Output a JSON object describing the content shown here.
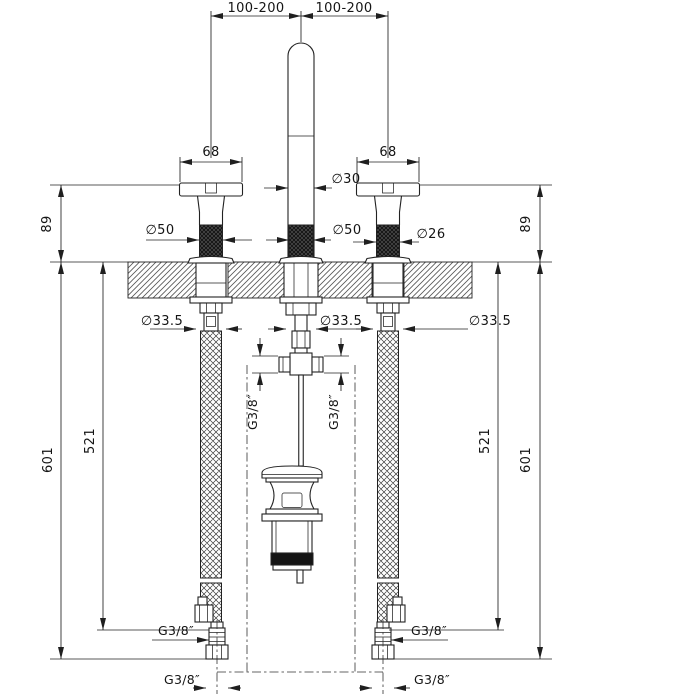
{
  "page": {
    "background": "#ffffff",
    "line_color": "#222222",
    "knurl_color": "#181818",
    "thread_band_color": "#151515"
  },
  "drawing": {
    "type": "technical-installation-drawing",
    "subject": "3-hole basin mixer with cross handles, high spout, pop-up waste and flexible supply hoses",
    "dimensions": {
      "top_span_left": "100-200",
      "top_span_right": "100-200",
      "handle_width_left": "68",
      "handle_width_right": "68",
      "spout_diameter": "∅30",
      "left_handle_diameter": "∅50",
      "spout_base_diameter": "∅50",
      "cartridge_diameter": "∅26",
      "deck_height_left": "89",
      "deck_height_right": "89",
      "shank_diameter_left": "∅33.5",
      "shank_diameter_center": "∅33.5",
      "shank_diameter_right": "∅33.5",
      "hose_length_inner_left": "521",
      "hose_length_inner_right": "521",
      "hose_length_outer_left": "601",
      "hose_length_outer_right": "601",
      "tee_thread_left": "G3/8″",
      "tee_thread_right": "G3/8″",
      "hose_thread_left": "G3/8″",
      "hose_thread_right": "G3/8″",
      "hose_end_thread_left": "G3/8″",
      "hose_end_thread_right": "G3/8″"
    }
  }
}
